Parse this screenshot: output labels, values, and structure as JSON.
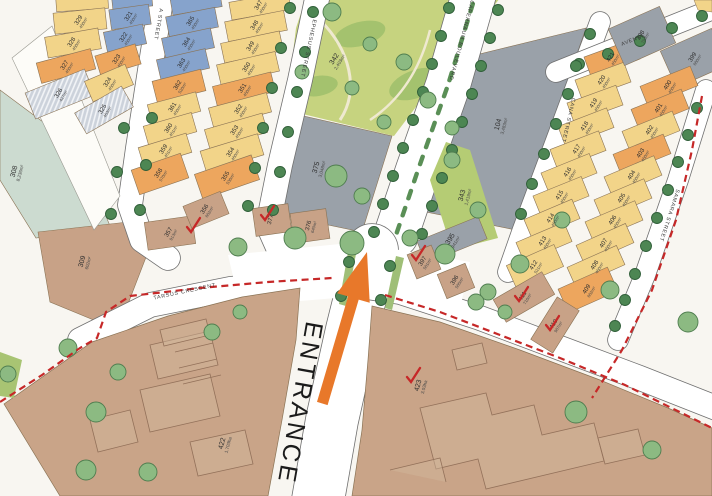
{
  "map": {
    "entrance_label": "ENTRANCE",
    "streets": {
      "a_street": "A STREET",
      "ephesus": "EPHESUS STREET",
      "capernaum": "CAPERNAUM BOULEVARD",
      "cana": "CANA STREET",
      "samara": "SAMARA STREET",
      "avenue": "AVENUE",
      "tarsus": "TARSUS CRESCENT"
    },
    "blocks": {
      "a_west": [
        {
          "n": "",
          "a": "",
          "c": "yellow"
        },
        {
          "n": "329",
          "a": "450m²",
          "c": "yellow"
        },
        {
          "n": "328",
          "a": "450m²",
          "c": "yellow"
        },
        {
          "n": "327",
          "a": "450m²",
          "c": "orange"
        },
        {
          "n": "326",
          "a": "427m²",
          "c": "hatch"
        }
      ],
      "a_east": [
        {
          "n": "",
          "a": "",
          "c": "blue"
        },
        {
          "n": "321",
          "a": "450m²",
          "c": "blue"
        },
        {
          "n": "322",
          "a": "450m²",
          "c": "blue"
        },
        {
          "n": "323",
          "a": "450m²",
          "c": "orange"
        },
        {
          "n": "324",
          "a": "450m²",
          "c": "yellow"
        },
        {
          "n": "325",
          "a": "463m²",
          "c": "hatch"
        }
      ],
      "b_west": [
        {
          "n": "",
          "a": "",
          "c": "blue"
        },
        {
          "n": "365",
          "a": "450m²",
          "c": "blue"
        },
        {
          "n": "364",
          "a": "450m²",
          "c": "blue"
        },
        {
          "n": "363",
          "a": "450m²",
          "c": "blue"
        },
        {
          "n": "362",
          "a": "520m²",
          "c": "orange"
        },
        {
          "n": "361",
          "a": "450m²",
          "c": "yellow"
        },
        {
          "n": "360",
          "a": "451m²",
          "c": "yellow"
        },
        {
          "n": "359",
          "a": "451m²",
          "c": "yellow"
        },
        {
          "n": "358",
          "a": "570m²",
          "c": "orange"
        }
      ],
      "b_east": [
        {
          "n": "347",
          "a": "450m²",
          "c": "yellow"
        },
        {
          "n": "348",
          "a": "450m²",
          "c": "yellow"
        },
        {
          "n": "349",
          "a": "450m²",
          "c": "yellow"
        },
        {
          "n": "350",
          "a": "450m²",
          "c": "yellow"
        },
        {
          "n": "351",
          "a": "450m²",
          "c": "orange"
        },
        {
          "n": "352",
          "a": "450m²",
          "c": "yellow"
        },
        {
          "n": "353",
          "a": "450m²",
          "c": "yellow"
        },
        {
          "n": "354",
          "a": "460m²",
          "c": "yellow"
        },
        {
          "n": "355",
          "a": "536m²",
          "c": "orange"
        }
      ],
      "cana_col": [
        {
          "n": "421",
          "a": "450m²",
          "c": "orange"
        },
        {
          "n": "420",
          "a": "450m²",
          "c": "yellow"
        },
        {
          "n": "419",
          "a": "450m²",
          "c": "yellow"
        },
        {
          "n": "418",
          "a": "450m²",
          "c": "yellow"
        },
        {
          "n": "417",
          "a": "450m²",
          "c": "yellow"
        },
        {
          "n": "416",
          "a": "450m²",
          "c": "yellow"
        },
        {
          "n": "415",
          "a": "450m²",
          "c": "yellow"
        },
        {
          "n": "414",
          "a": "450m²",
          "c": "yellow"
        },
        {
          "n": "413",
          "a": "450m²",
          "c": "yellow"
        },
        {
          "n": "412",
          "a": "521m²",
          "c": "yellow"
        }
      ],
      "samara_col": [
        {
          "n": "398",
          "a": "793m²",
          "c": "gray"
        },
        {
          "n": "399",
          "a": "680m²",
          "c": "gray"
        },
        {
          "n": "400",
          "a": "450m²",
          "c": "orange"
        },
        {
          "n": "401",
          "a": "450m²",
          "c": "orange"
        },
        {
          "n": "402",
          "a": "450m²",
          "c": "yellow"
        },
        {
          "n": "403",
          "a": "450m²",
          "c": "orange"
        },
        {
          "n": "404",
          "a": "450m²",
          "c": "yellow"
        },
        {
          "n": "405",
          "a": "450m²",
          "c": "yellow"
        },
        {
          "n": "406",
          "a": "450m²",
          "c": "yellow"
        },
        {
          "n": "407",
          "a": "450m²",
          "c": "yellow"
        },
        {
          "n": "408",
          "a": "450m²",
          "c": "yellow"
        },
        {
          "n": "409",
          "a": "602m²",
          "c": "orange"
        }
      ],
      "east_bottom": [
        {
          "n": "411",
          "a": "716m²",
          "c": "tan"
        },
        {
          "n": "410",
          "a": "907m²",
          "c": "tan"
        }
      ],
      "tan_mid": [
        {
          "n": "357",
          "a": "913m²",
          "c": "tan"
        },
        {
          "n": "356",
          "a": "602m²",
          "c": "tan"
        },
        {
          "n": "377",
          "a": "",
          "c": "tan"
        },
        {
          "n": "376",
          "a": "640m²",
          "c": "tan"
        },
        {
          "n": "397",
          "a": "501m²",
          "c": "tan"
        },
        {
          "n": "396",
          "a": "505m²",
          "c": "tan"
        }
      ]
    },
    "parcels": {
      "p308": {
        "n": "308",
        "a": "8,236m²",
        "c": "paleGreen"
      },
      "p309": {
        "n": "309",
        "a": "602m²",
        "c": "tan"
      },
      "p342": {
        "n": "342",
        "a": "2,403m²",
        "c": "park"
      },
      "p343": {
        "n": "343",
        "a": "1,419m²",
        "c": "parkStrip"
      },
      "p375": {
        "n": "375",
        "a": "3,048m²",
        "c": "gray"
      },
      "p104": {
        "n": "104",
        "a": "3,483m²",
        "c": "gray"
      },
      "p395": {
        "n": "395",
        "a": "941m²",
        "c": "gray"
      },
      "p422": {
        "n": "422",
        "a": "1.703ha",
        "c": "tanBig"
      },
      "p423": {
        "n": "423",
        "a": "3.03ha",
        "c": "tanBig"
      }
    },
    "colors": {
      "yellow": "#f2d489",
      "orange": "#eda65e",
      "blue": "#86a3cc",
      "gray": "#9aa1a9",
      "tan": "#c8a287",
      "tanBig": "#c9a488",
      "paleGreen": "#ccdbd0",
      "park": "#c6d37f",
      "parkStrip": "#b5cc74",
      "parkPatch": "#a4c26e",
      "road": "#ffffff",
      "roadEdge": "#6f6f6f",
      "dashRed": "#c62828",
      "arrowOrange": "#e8782a",
      "streetTree": "#4d8653",
      "streetTreeEdge": "#2f5e38",
      "ornTree": "#8cba82",
      "ornTreeEdge": "#4f7d4f",
      "hatchBg": "#ccd2db",
      "hatchLine": "#f2f4f7",
      "lotLine": "#8a7355",
      "buildingLine": "#93715a",
      "text": "#2e2e2e"
    }
  }
}
